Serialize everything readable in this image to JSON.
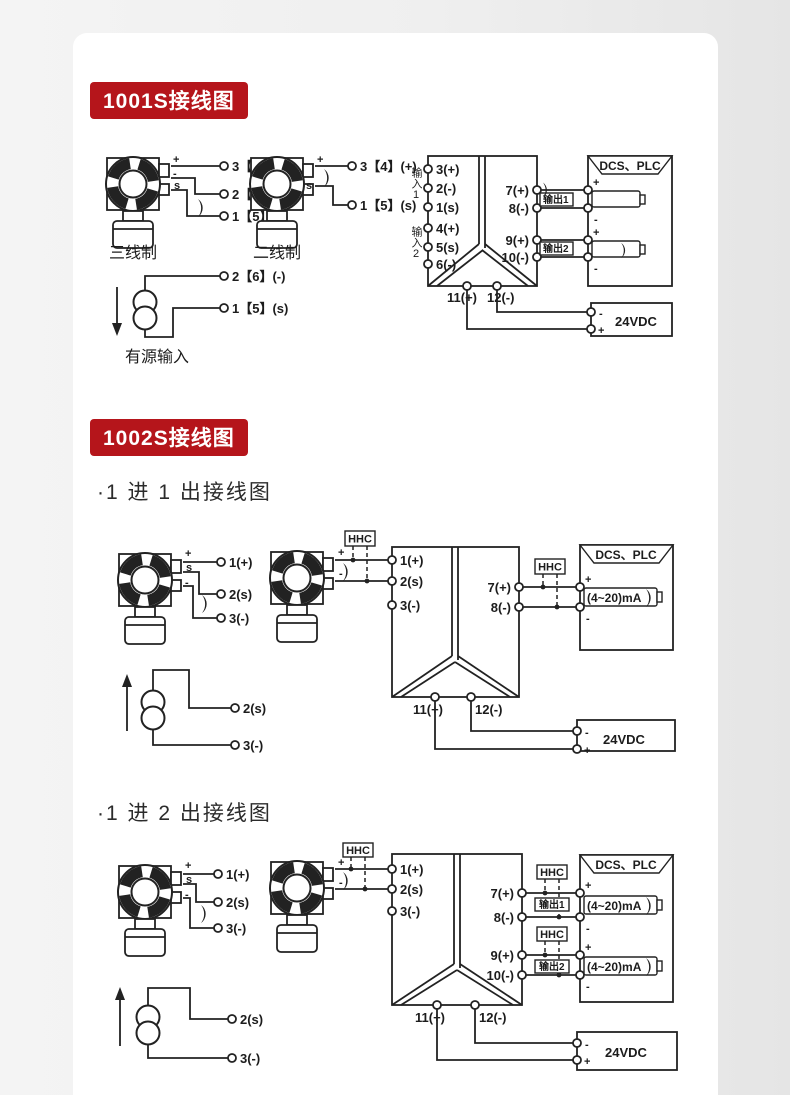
{
  "page": {
    "bg_left": "#f4f4f4",
    "bg_right": "#e5e5e5",
    "card_bg": "#ffffff"
  },
  "colors": {
    "badge": "#b5151b",
    "badge_text": "#ffffff",
    "line": "#222222"
  },
  "sections": {
    "s1": {
      "badge": "1001S接线图"
    },
    "s2": {
      "badge": "1002S接线图",
      "sub1": "·1 进 1 出接线图",
      "sub2": "·1 进 2 出接线图"
    }
  },
  "d1": {
    "three_wire": "三线制",
    "two_wire": "二线制",
    "active_input": "有源输入",
    "t1": [
      "3【4】(+)",
      "2【6】(-)",
      "1【5】(s)"
    ],
    "t1_marks": [
      "+",
      "-",
      "s"
    ],
    "t2": [
      "3【4】(+)",
      "1【5】(s)"
    ],
    "t2_marks": [
      "+",
      "s"
    ],
    "src": [
      "2【6】(-)",
      "1【5】(s)"
    ],
    "in1": "输入1",
    "in2": "输入2",
    "blockL": [
      "3(+)",
      "2(-)",
      "1(s)",
      "4(+)",
      "5(s)",
      "6(-)"
    ],
    "blockR": [
      "7(+)",
      "8(-)",
      "9(+)",
      "10(-)"
    ],
    "out1": "输出1",
    "out2": "输出2",
    "bottom": [
      "11(+)",
      "12(-)"
    ],
    "dcs": "DCS、PLC",
    "vdc": "24VDC",
    "plus": "+",
    "minus": "-"
  },
  "d2": {
    "t1": [
      "1(+)",
      "2(s)",
      "3(-)"
    ],
    "t1_marks": [
      "+",
      "s",
      "-"
    ],
    "t2_marks": [
      "+",
      "-"
    ],
    "hhc": "HHC",
    "blockL": [
      "1(+)",
      "2(s)",
      "3(-)"
    ],
    "blockR": [
      "7(+)",
      "8(-)"
    ],
    "bottom": [
      "11(+)",
      "12(-)"
    ],
    "src": [
      "2(s)",
      "3(-)"
    ],
    "dcs": "DCS、PLC",
    "ma": "(4~20)mA",
    "vdc": "24VDC",
    "plus": "+",
    "minus": "-"
  },
  "d3": {
    "t1": [
      "1(+)",
      "2(s)",
      "3(-)"
    ],
    "t1_marks": [
      "+",
      "s",
      "-"
    ],
    "t2_marks": [
      "+",
      "-"
    ],
    "hhc": "HHC",
    "blockL": [
      "1(+)",
      "2(s)",
      "3(-)"
    ],
    "blockR": [
      "7(+)",
      "8(-)",
      "9(+)",
      "10(-)"
    ],
    "out1": "输出1",
    "out2": "输出2",
    "bottom": [
      "11(+)",
      "12(-)"
    ],
    "src": [
      "2(s)",
      "3(-)"
    ],
    "dcs": "DCS、PLC",
    "ma": "(4~20)mA",
    "vdc": "24VDC",
    "plus": "+",
    "minus": "-"
  }
}
